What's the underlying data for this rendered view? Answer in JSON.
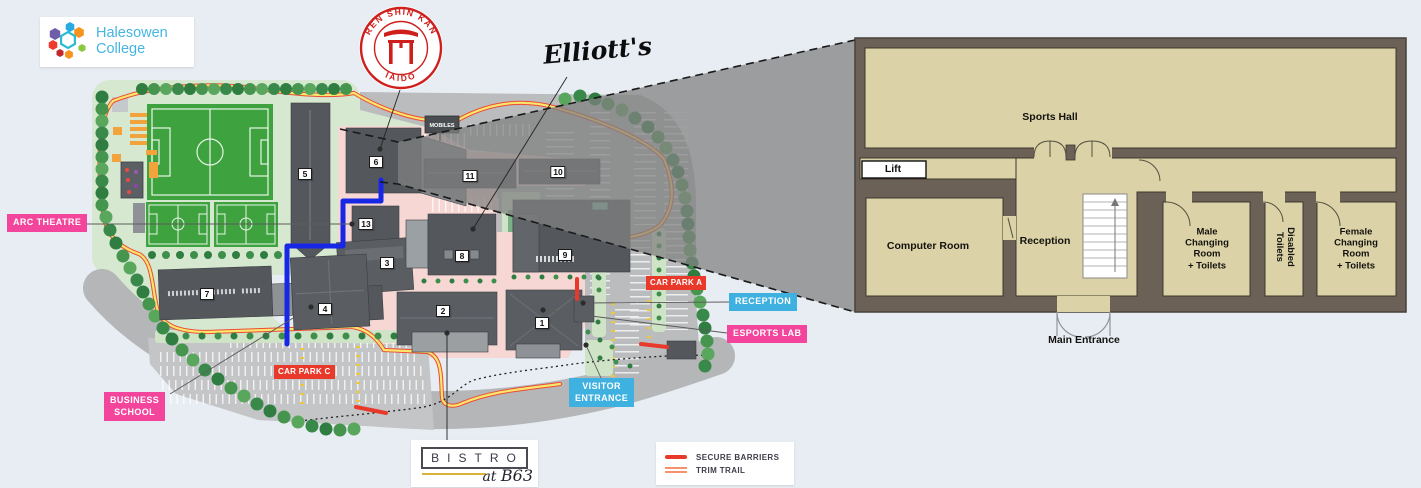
{
  "logos": {
    "college": {
      "line1": "Halesowen",
      "line2": "College",
      "text_color": "#45b5e2"
    },
    "dojo": {
      "arc_top": "REN SHIN KAN",
      "arc_bottom": "IAIDO",
      "color": "#cf1f1c"
    },
    "elliotts": "Elliott's",
    "bistro": {
      "letters": "BISTRO",
      "at": "at",
      "b63": "B63"
    }
  },
  "map": {
    "labels": {
      "arc_theatre": "ARC THEATRE",
      "business_school_line1": "BUSINESS",
      "business_school_line2": "SCHOOL",
      "reception": "RECEPTION",
      "esports_lab": "ESPORTS LAB",
      "visitor_entrance_line1": "VISITOR",
      "visitor_entrance_line2": "ENTRANCE",
      "car_park_a": "CAR PARK A",
      "car_park_c": "CAR PARK C",
      "mobiles_sign": "MOBILES"
    },
    "label_colors": {
      "pink": "#f2459b",
      "blue": "#3fb1e0",
      "red": "#e8392b"
    },
    "route_color": "#1826e6",
    "badges": [
      {
        "n": "1",
        "x": 542,
        "y": 323
      },
      {
        "n": "2",
        "x": 443,
        "y": 311
      },
      {
        "n": "3",
        "x": 387,
        "y": 263
      },
      {
        "n": "4",
        "x": 325,
        "y": 309
      },
      {
        "n": "5",
        "x": 305,
        "y": 174
      },
      {
        "n": "6",
        "x": 376,
        "y": 162
      },
      {
        "n": "7",
        "x": 207,
        "y": 294
      },
      {
        "n": "8",
        "x": 462,
        "y": 256
      },
      {
        "n": "9",
        "x": 565,
        "y": 255
      },
      {
        "n": "10",
        "x": 558,
        "y": 172
      },
      {
        "n": "11",
        "x": 470,
        "y": 176
      },
      {
        "n": "13",
        "x": 366,
        "y": 224
      }
    ]
  },
  "legend": {
    "items": [
      {
        "label": "SECURE BARRIERS",
        "swatch": "solid-red",
        "color": "#e8392b"
      },
      {
        "label": "TRIM TRAIL",
        "swatch": "double-orange",
        "color": "#f5926c"
      }
    ]
  },
  "floor_plan": {
    "sports_hall": "Sports Hall",
    "lift": "Lift",
    "computer_room": "Computer Room",
    "reception": "Reception",
    "male_changing": "Male\nChanging\nRoom\n+ Toilets",
    "disabled_toilets": "Disabled\nToilets",
    "female_changing": "Female\nChanging\nRoom\n+ Toilets",
    "main_entrance": "Main Entrance",
    "floor_color": "#dbd3a7",
    "wall_color": "#6b6156"
  }
}
